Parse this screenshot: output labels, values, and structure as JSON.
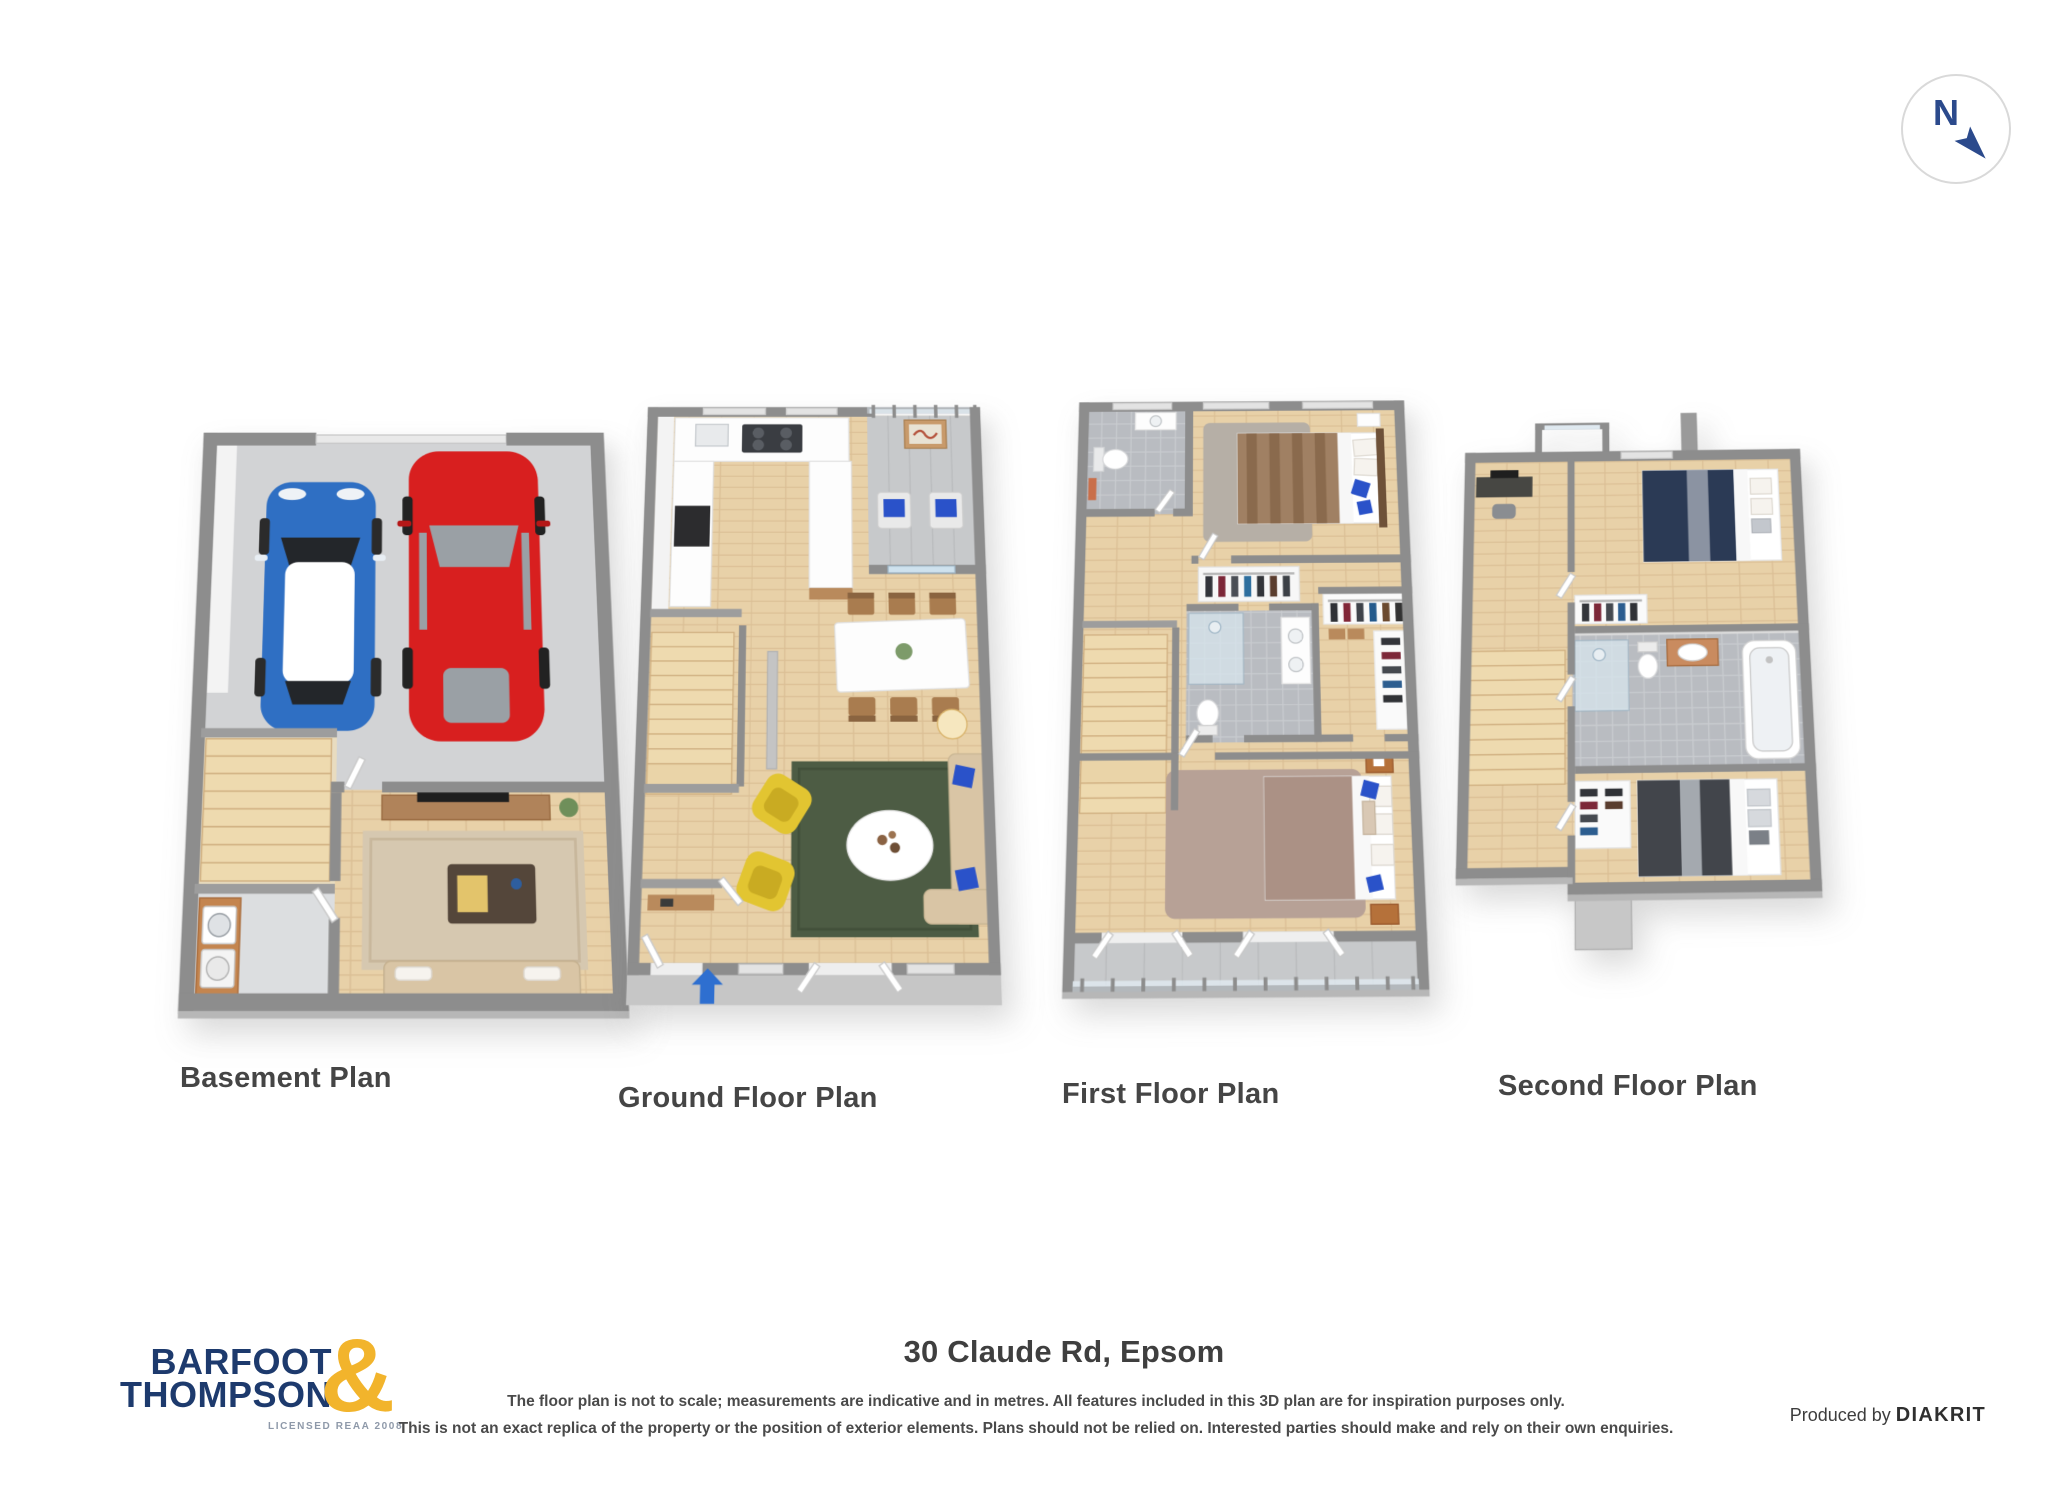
{
  "page": {
    "background": "#ffffff"
  },
  "compass": {
    "letter": "N"
  },
  "plans": [
    {
      "id": "basement",
      "label": "Basement Plan"
    },
    {
      "id": "ground",
      "label": "Ground Floor Plan"
    },
    {
      "id": "first",
      "label": "First Floor Plan"
    },
    {
      "id": "second",
      "label": "Second Floor Plan"
    }
  ],
  "address": "30 Claude Rd, Epsom",
  "disclaimer": {
    "line1": "The floor plan is not to scale; measurements are indicative and in metres. All features included in this 3D plan are for inspiration purposes only.",
    "line2": "This is not an exact replica of the property or the position of exterior elements. Plans should not be relied on. Interested parties should make and rely on their own enquiries."
  },
  "credits": {
    "producer_prefix": "Produced by",
    "producer_name": "DIAKRIT"
  },
  "logo": {
    "line1": "BARFOOT",
    "line2": "THOMPSON",
    "ampersand": "&",
    "tagline": "LICENSED REAA 2008"
  },
  "colors": {
    "brand_navy": "#1d3a6d",
    "brand_gold": "#f2b42c",
    "compass_navy": "#2b4a8c",
    "label_gray": "#454545",
    "wall_gray": "#8d8d8d",
    "concrete_gray": "#d2d3d5",
    "wood_floor": "#e8d1a8",
    "tile_gray": "#c6c8cc",
    "car_blue": "#2f6fc3",
    "car_red": "#d81f1f",
    "chair_yellow": "#e2c531",
    "rug_green": "#4d5c44",
    "sofa_beige": "#d9c5a5",
    "pillow_blue": "#2a52c9",
    "entry_arrow_blue": "#2e6fd0",
    "bed_brown": "#a08063",
    "bed_mauve": "#ab9185",
    "bed_navy": "#2b3a55",
    "bed_charcoal": "#42454b",
    "rug_pink": "#b7a196"
  }
}
